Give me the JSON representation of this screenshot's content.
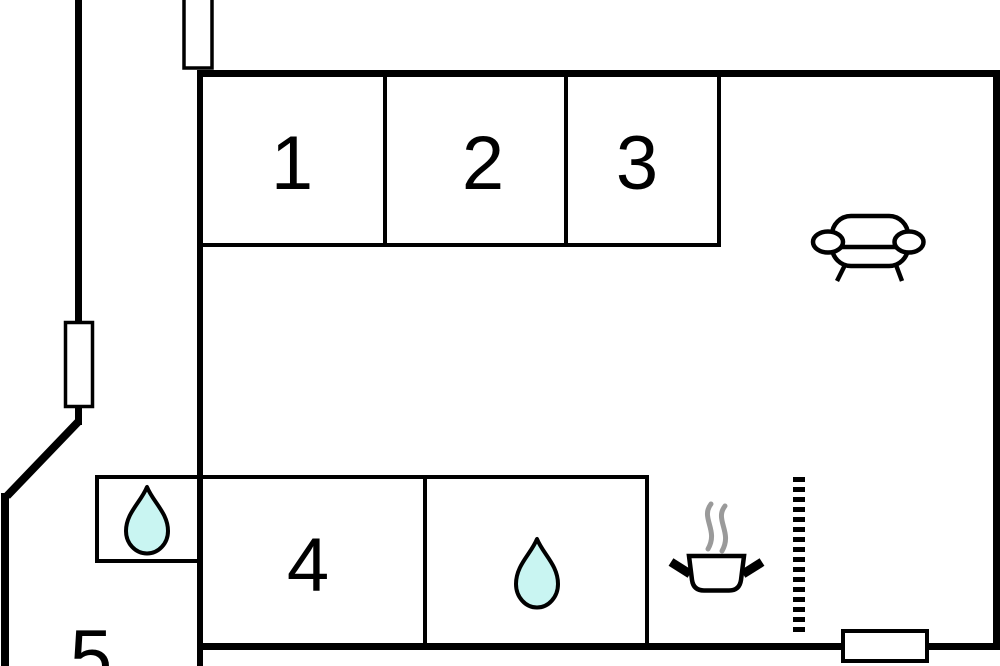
{
  "plan": {
    "type": "floor-plan",
    "rooms": [
      {
        "name": "room-1",
        "label": "1"
      },
      {
        "name": "room-2",
        "label": "2"
      },
      {
        "name": "room-3",
        "label": "3"
      },
      {
        "name": "room-4",
        "label": "4"
      },
      {
        "name": "room-5",
        "label": "5"
      }
    ],
    "icons": {
      "sofa": "sofa-icon",
      "water_drop_small_room": "water-drop-icon",
      "water_drop_bathroom": "water-drop-icon",
      "cooking_pot": "cooking-pot-icon",
      "steam": "steam-icon",
      "window_top": "window-symbol",
      "window_left": "window-symbol",
      "window_bottom": "window-symbol",
      "dashed_partition": "dashed-partition-line"
    },
    "colors": {
      "wall": "#000000",
      "background": "#ffffff",
      "water": "#c9f5f2",
      "steam": "#9a9a9a"
    }
  }
}
